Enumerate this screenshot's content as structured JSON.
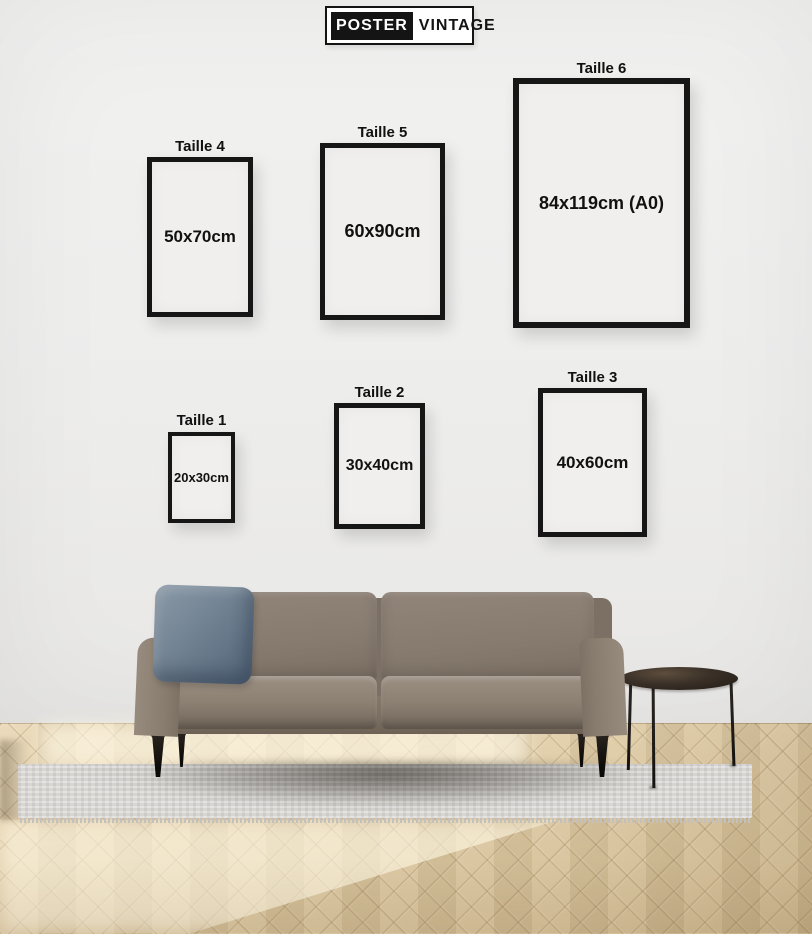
{
  "logo": {
    "primary": "POSTER",
    "secondary": "VINTAGE"
  },
  "sizes": [
    {
      "label": "Taille 1",
      "dimensions": "20x30cm"
    },
    {
      "label": "Taille 2",
      "dimensions": "30x40cm"
    },
    {
      "label": "Taille 3",
      "dimensions": "40x60cm"
    },
    {
      "label": "Taille 4",
      "dimensions": "50x70cm"
    },
    {
      "label": "Taille 5",
      "dimensions": "60x90cm"
    },
    {
      "label": "Taille 6",
      "dimensions": "84x119cm (A0)"
    }
  ],
  "colors": {
    "wall": "#ededec",
    "frame_border": "#161616",
    "text": "#111111",
    "logo_bg": "#141414",
    "sofa": "#8d8174",
    "pillow": "#6f8191",
    "sofa_legs": "#17130e",
    "table": "#3a3027",
    "rug": "#d8d6d3",
    "floor_wood": "#dcc8a2"
  }
}
